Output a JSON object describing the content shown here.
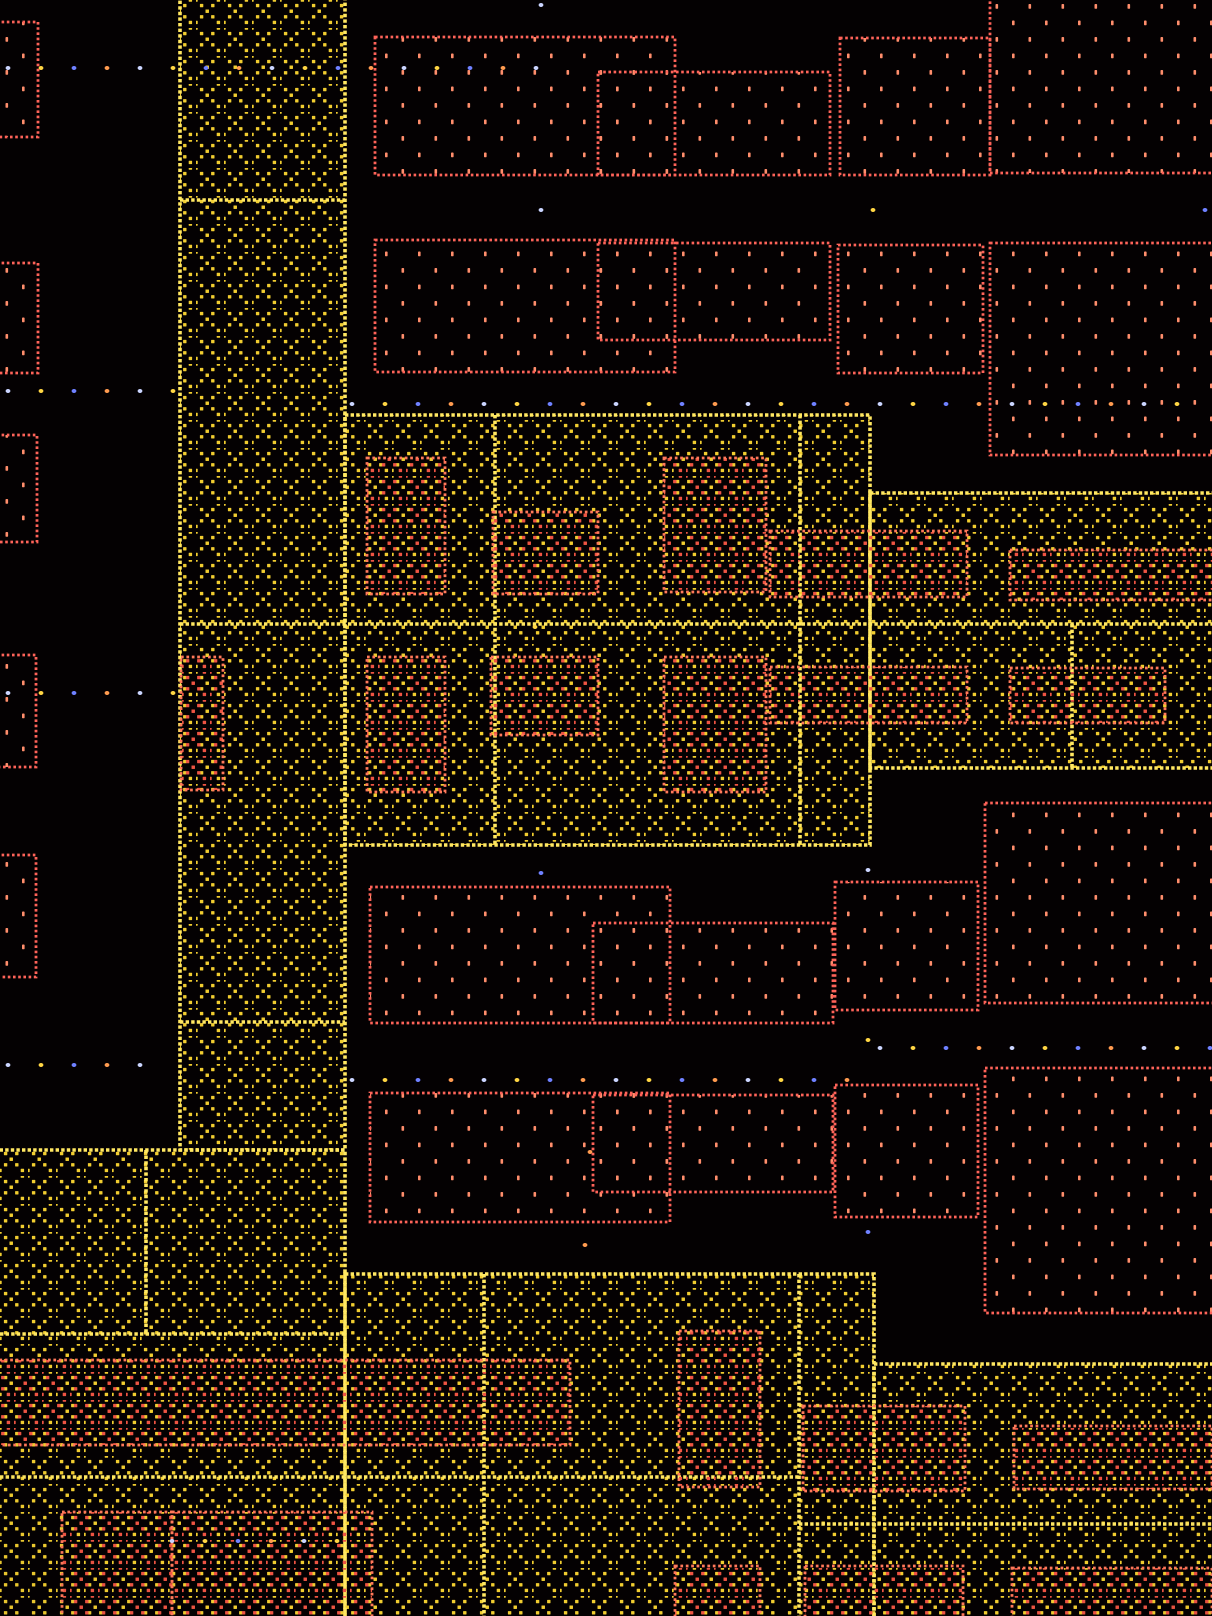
{
  "canvas": {
    "width": 1212,
    "height": 1616,
    "background": "#040102"
  },
  "palette": {
    "background": "#040102",
    "lattice_yellow": "#e9c93a",
    "border_yellow": "#ffe36a",
    "stipple_fill": "#ff8d6e",
    "stipple_border": "#f0635a",
    "hatch_red": "#e05545",
    "hatch_border": "#ff7a5e",
    "dot_colors": [
      "#c9d2ff",
      "#ffd34d",
      "#7080ff",
      "#ff9a55"
    ]
  },
  "layers": {
    "yellow_regions": [
      {
        "name": "metal-region-vband",
        "x": 180,
        "y": -6,
        "w": 165,
        "h": 1156
      },
      {
        "name": "metal-region-mid",
        "x": 345,
        "y": 415,
        "w": 525,
        "h": 430
      },
      {
        "name": "metal-region-right",
        "x": 870,
        "y": 493,
        "w": 348,
        "h": 275
      },
      {
        "name": "metal-region-bottom-left",
        "x": -6,
        "y": 1150,
        "w": 351,
        "h": 472
      },
      {
        "name": "metal-region-bottom-mid",
        "x": 345,
        "y": 1274,
        "w": 529,
        "h": 348
      },
      {
        "name": "metal-region-bottom-right",
        "x": 874,
        "y": 1364,
        "w": 344,
        "h": 258
      }
    ],
    "yellow_inner_lines": [
      {
        "x1": 180,
        "y1": 200,
        "x2": 345,
        "y2": 200
      },
      {
        "x1": 180,
        "y1": 624,
        "x2": 1212,
        "y2": 624
      },
      {
        "x1": 180,
        "y1": 1022,
        "x2": 345,
        "y2": 1022
      },
      {
        "x1": 495,
        "y1": 415,
        "x2": 495,
        "y2": 845
      },
      {
        "x1": 800,
        "y1": 415,
        "x2": 800,
        "y2": 845
      },
      {
        "x1": 1072,
        "y1": 624,
        "x2": 1072,
        "y2": 768
      },
      {
        "x1": 146,
        "y1": 1150,
        "x2": 146,
        "y2": 1334
      },
      {
        "x1": 0,
        "y1": 1334,
        "x2": 345,
        "y2": 1334
      },
      {
        "x1": 799,
        "y1": 1274,
        "x2": 799,
        "y2": 1616
      },
      {
        "x1": 484,
        "y1": 1274,
        "x2": 484,
        "y2": 1616
      },
      {
        "x1": 0,
        "y1": 1477,
        "x2": 799,
        "y2": 1477
      },
      {
        "x1": 799,
        "y1": 1524,
        "x2": 1212,
        "y2": 1524
      }
    ],
    "red_stipple_rects": [
      {
        "name": "cell-rect",
        "x": -14,
        "y": 22,
        "w": 52,
        "h": 115
      },
      {
        "name": "cell-rect",
        "x": -14,
        "y": 263,
        "w": 52,
        "h": 110
      },
      {
        "name": "cell-rect",
        "x": -14,
        "y": 435,
        "w": 51,
        "h": 107
      },
      {
        "name": "cell-rect",
        "x": -14,
        "y": 655,
        "w": 50,
        "h": 112
      },
      {
        "name": "cell-rect",
        "x": -14,
        "y": 855,
        "w": 50,
        "h": 122
      },
      {
        "name": "cell-rect",
        "x": 375,
        "y": 37,
        "w": 300,
        "h": 138
      },
      {
        "name": "cell-rect",
        "x": 598,
        "y": 72,
        "w": 232,
        "h": 103
      },
      {
        "name": "cell-rect",
        "x": 840,
        "y": 38,
        "w": 150,
        "h": 137
      },
      {
        "name": "cell-rect",
        "x": 990,
        "y": -8,
        "w": 228,
        "h": 181
      },
      {
        "name": "cell-rect",
        "x": 375,
        "y": 240,
        "w": 300,
        "h": 132
      },
      {
        "name": "cell-rect",
        "x": 598,
        "y": 243,
        "w": 232,
        "h": 97
      },
      {
        "name": "cell-rect",
        "x": 838,
        "y": 245,
        "w": 145,
        "h": 128
      },
      {
        "name": "cell-rect",
        "x": 990,
        "y": 243,
        "w": 228,
        "h": 212
      },
      {
        "name": "cell-rect",
        "x": 370,
        "y": 887,
        "w": 300,
        "h": 136
      },
      {
        "name": "cell-rect",
        "x": 593,
        "y": 923,
        "w": 240,
        "h": 100
      },
      {
        "name": "cell-rect",
        "x": 835,
        "y": 882,
        "w": 143,
        "h": 128
      },
      {
        "name": "cell-rect",
        "x": 985,
        "y": 803,
        "w": 233,
        "h": 200
      },
      {
        "name": "cell-rect",
        "x": 370,
        "y": 1093,
        "w": 300,
        "h": 129
      },
      {
        "name": "cell-rect",
        "x": 593,
        "y": 1095,
        "w": 240,
        "h": 97
      },
      {
        "name": "cell-rect",
        "x": 835,
        "y": 1085,
        "w": 143,
        "h": 132
      },
      {
        "name": "cell-rect",
        "x": 985,
        "y": 1068,
        "w": 233,
        "h": 245
      }
    ],
    "red_hatch_rects": [
      {
        "name": "overlay-rect",
        "x": 367,
        "y": 458,
        "w": 78,
        "h": 136
      },
      {
        "name": "overlay-rect",
        "x": 493,
        "y": 512,
        "w": 105,
        "h": 82
      },
      {
        "name": "overlay-rect",
        "x": 664,
        "y": 458,
        "w": 102,
        "h": 134
      },
      {
        "name": "overlay-rect",
        "x": 770,
        "y": 531,
        "w": 197,
        "h": 66
      },
      {
        "name": "overlay-rect",
        "x": 1010,
        "y": 550,
        "w": 208,
        "h": 50
      },
      {
        "name": "overlay-rect",
        "x": 367,
        "y": 657,
        "w": 78,
        "h": 135
      },
      {
        "name": "overlay-rect",
        "x": 491,
        "y": 657,
        "w": 107,
        "h": 78
      },
      {
        "name": "overlay-rect",
        "x": 664,
        "y": 657,
        "w": 102,
        "h": 135
      },
      {
        "name": "overlay-rect",
        "x": 770,
        "y": 667,
        "w": 197,
        "h": 56
      },
      {
        "name": "overlay-rect",
        "x": 1010,
        "y": 668,
        "w": 155,
        "h": 55
      },
      {
        "name": "overlay-rect",
        "x": 181,
        "y": 657,
        "w": 42,
        "h": 133
      },
      {
        "name": "overlay-rect",
        "x": 679,
        "y": 1331,
        "w": 81,
        "h": 156
      },
      {
        "name": "overlay-rect",
        "x": 803,
        "y": 1406,
        "w": 162,
        "h": 85
      },
      {
        "name": "overlay-rect",
        "x": 1014,
        "y": 1426,
        "w": 198,
        "h": 63
      },
      {
        "name": "overlay-rect",
        "x": -6,
        "y": 1360,
        "w": 576,
        "h": 85
      },
      {
        "name": "overlay-rect",
        "x": 675,
        "y": 1566,
        "w": 85,
        "h": 54
      },
      {
        "name": "overlay-rect",
        "x": 805,
        "y": 1566,
        "w": 158,
        "h": 54
      },
      {
        "name": "overlay-rect",
        "x": 1012,
        "y": 1568,
        "w": 200,
        "h": 52
      },
      {
        "name": "overlay-rect",
        "x": 62,
        "y": 1512,
        "w": 110,
        "h": 108
      },
      {
        "name": "overlay-rect",
        "x": 172,
        "y": 1512,
        "w": 200,
        "h": 108
      }
    ],
    "dot_rows": [
      {
        "y": 68,
        "x0": 8,
        "count": 17,
        "spacing": 33
      },
      {
        "y": 210,
        "x0": 541,
        "count": 3,
        "spacing": 332
      },
      {
        "y": 391,
        "x0": 8,
        "count": 6,
        "spacing": 33
      },
      {
        "y": 404,
        "x0": 352,
        "count": 26,
        "spacing": 33
      },
      {
        "y": 693,
        "x0": 8,
        "count": 6,
        "spacing": 33
      },
      {
        "y": 1048,
        "x0": 880,
        "count": 11,
        "spacing": 33
      },
      {
        "y": 1065,
        "x0": 8,
        "count": 5,
        "spacing": 33
      },
      {
        "y": 1080,
        "x0": 352,
        "count": 16,
        "spacing": 33
      },
      {
        "y": 1541,
        "x0": 172,
        "count": 6,
        "spacing": 33
      }
    ],
    "lone_dots": [
      {
        "x": 541,
        "y": 5
      },
      {
        "x": 535,
        "y": 627
      },
      {
        "x": 541,
        "y": 873
      },
      {
        "x": 585,
        "y": 1245
      },
      {
        "x": 868,
        "y": 870
      },
      {
        "x": 868,
        "y": 1040
      },
      {
        "x": 868,
        "y": 1232
      },
      {
        "x": 590,
        "y": 1152
      }
    ]
  }
}
